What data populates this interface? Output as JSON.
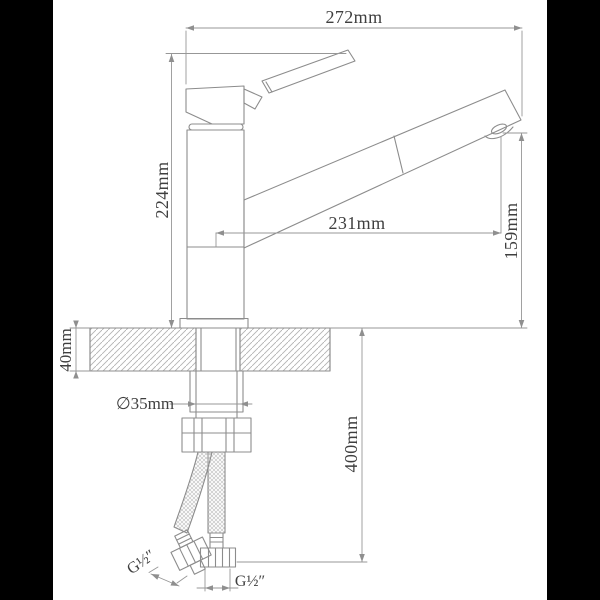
{
  "colors": {
    "background": "#000000",
    "paper": "#ffffff",
    "object_lines": "#8c8c8c",
    "dimension_lines": "#979797",
    "hatch_lines": "#b3b3b3",
    "braid_lines": "#c6c6c6",
    "text": "#3f3f3f",
    "arrow_fill": "#8f8f8f"
  },
  "dimensions": {
    "overall_reach": "272mm",
    "body_height": "224mm",
    "spout_reach": "231mm",
    "spout_outlet_height": "159mm",
    "mounting_thickness": "40mm",
    "hole_diameter": "∅35mm",
    "hose_length": "400mm",
    "hose_thread_left": "G½″",
    "hose_thread_right": "G½″"
  }
}
